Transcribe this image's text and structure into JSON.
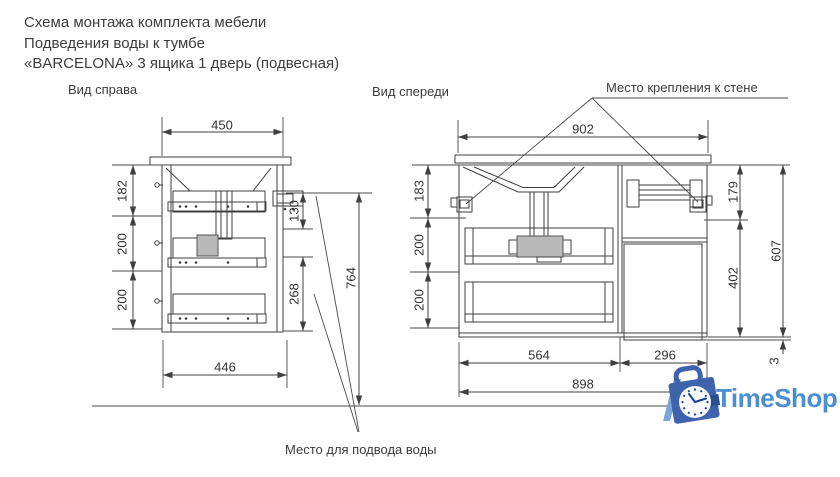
{
  "title": {
    "line1": "Схема монтажа комплекта мебели",
    "line2": "Подведения воды к тумбе",
    "line3": "«BARCELONA» 3 ящика 1 дверь (подвесная)"
  },
  "labels": {
    "side_view": "Вид справа",
    "front_view": "Вид спереди",
    "wall_mount": "Место крепления к стене",
    "water_supply": "Место для подвода воды"
  },
  "dims": {
    "side": {
      "width_top": "450",
      "drawer1": "182",
      "drawer2": "200",
      "drawer3": "200",
      "bracket_offset": "130",
      "lower_back": "268",
      "mount_height": "764",
      "width_bottom": "446"
    },
    "front": {
      "width_top": "902",
      "drawer1": "183",
      "drawer2": "200",
      "drawer3": "200",
      "right_top": "179",
      "right_door": "402",
      "height": "607",
      "door_gap": "3",
      "drawers_width": "564",
      "door_width": "296",
      "width_bottom": "898"
    }
  },
  "logo": {
    "text": "TimeShop",
    "colors": {
      "bag": "#3e63ac",
      "bag_dark": "#2b4d94",
      "stripe": "#7aa6d9",
      "clock_face": "#f7fafd",
      "hands": "#1c3f8f",
      "text": "#4b8fd2"
    }
  }
}
